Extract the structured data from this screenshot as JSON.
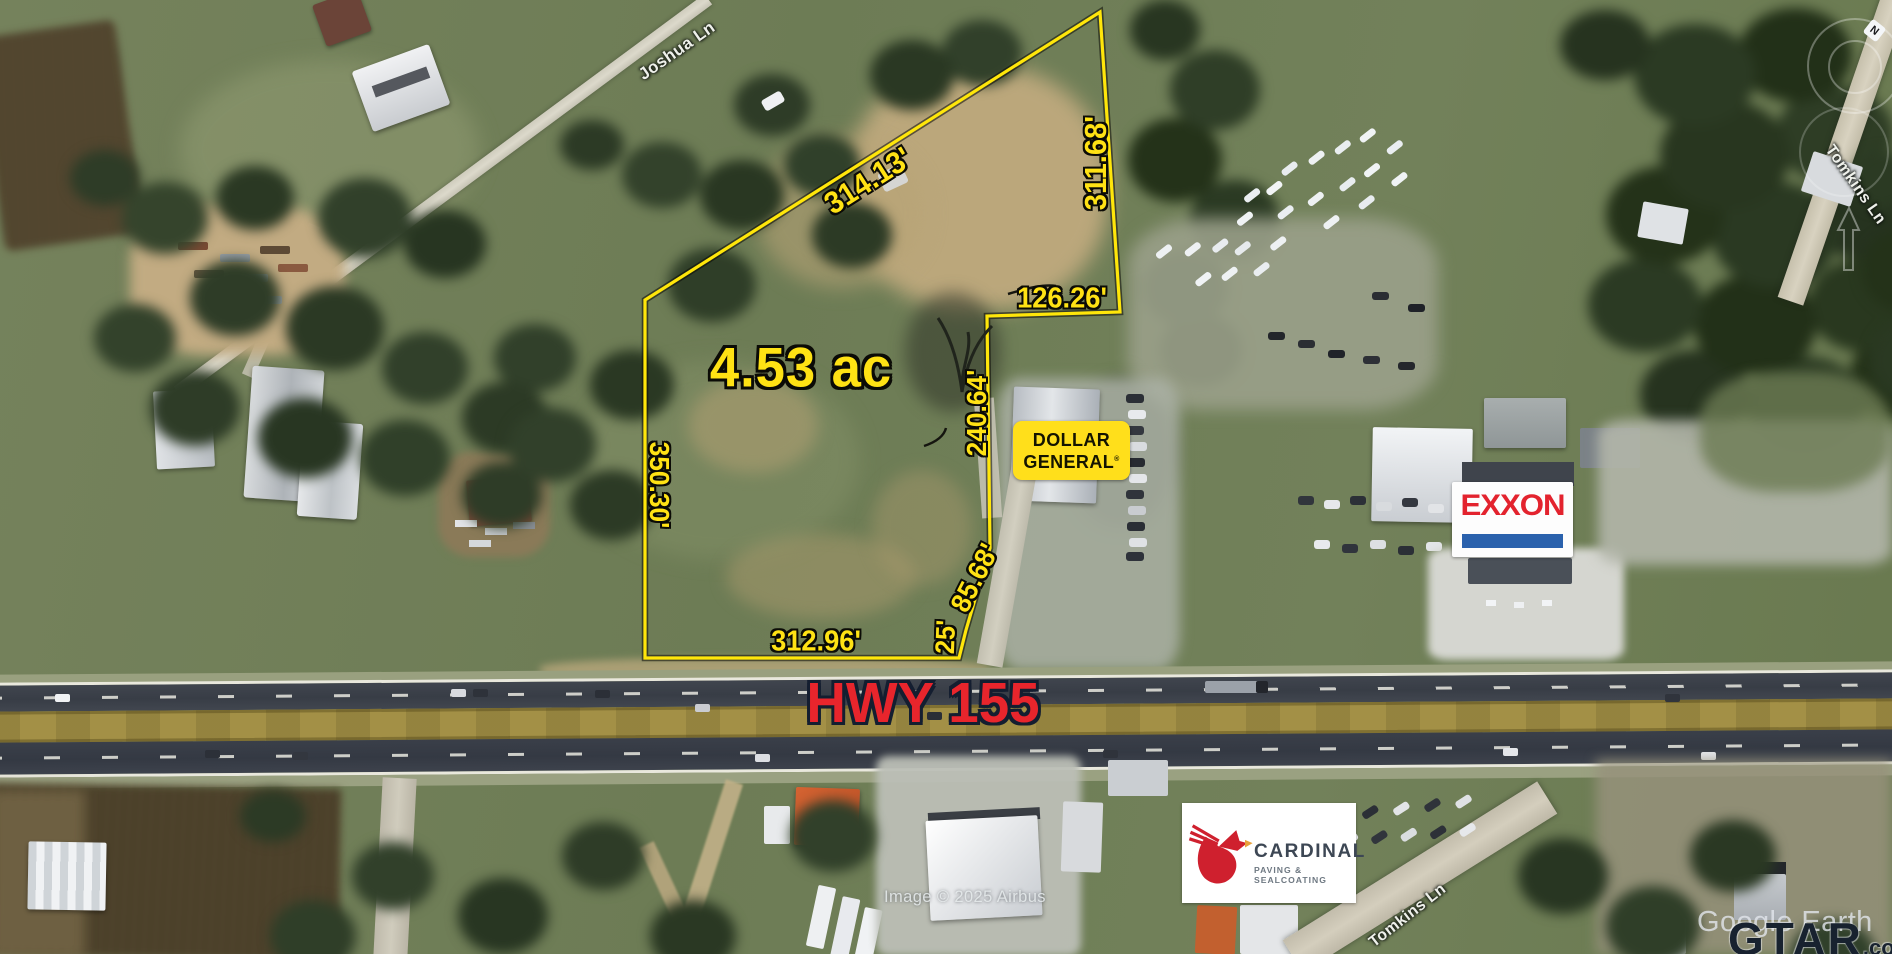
{
  "app": {
    "type": "aerial-property-listing-map"
  },
  "parcel": {
    "area_label": "4.53 ac",
    "outline_color": "#ffe60a",
    "polygon_points": "645,300 1100,12 1120,312 987,316 990,548 966,630 959,658 645,658",
    "dimensions": {
      "north": "314.13'",
      "northeast": "311.68'",
      "east_jog": "126.26'",
      "east": "240.64'",
      "west": "350.30'",
      "southeast_diag": "85.68'",
      "southeast_short": "25'",
      "south": "312.96'"
    }
  },
  "roads": {
    "highway": {
      "label": "HWY 155",
      "label_color": "#e8252c"
    },
    "joshua_ln": "Joshua Ln",
    "tomkins_ln_north": "Tomkins Ln",
    "tomkins_ln_south": "Tomkins Ln"
  },
  "businesses": {
    "dollar_general": {
      "line1": "DOLLAR",
      "line2": "GENERAL",
      "reg_mark": "®",
      "sign_bg": "#ffdf1b"
    },
    "exxon": {
      "name": "EXXON",
      "text_color": "#e3232e",
      "stripe_color": "#2b62ad"
    },
    "cardinal": {
      "name": "CARDINAL",
      "tagline": "PAVING & SEALCOATING",
      "logo_red": "#cf202e"
    }
  },
  "watermarks": {
    "imagery": "Image © 2025 Airbus",
    "provider": "Google Earth",
    "site_name": "GTAR",
    "site_suffix": ".com"
  },
  "compass": {
    "north": "N"
  }
}
